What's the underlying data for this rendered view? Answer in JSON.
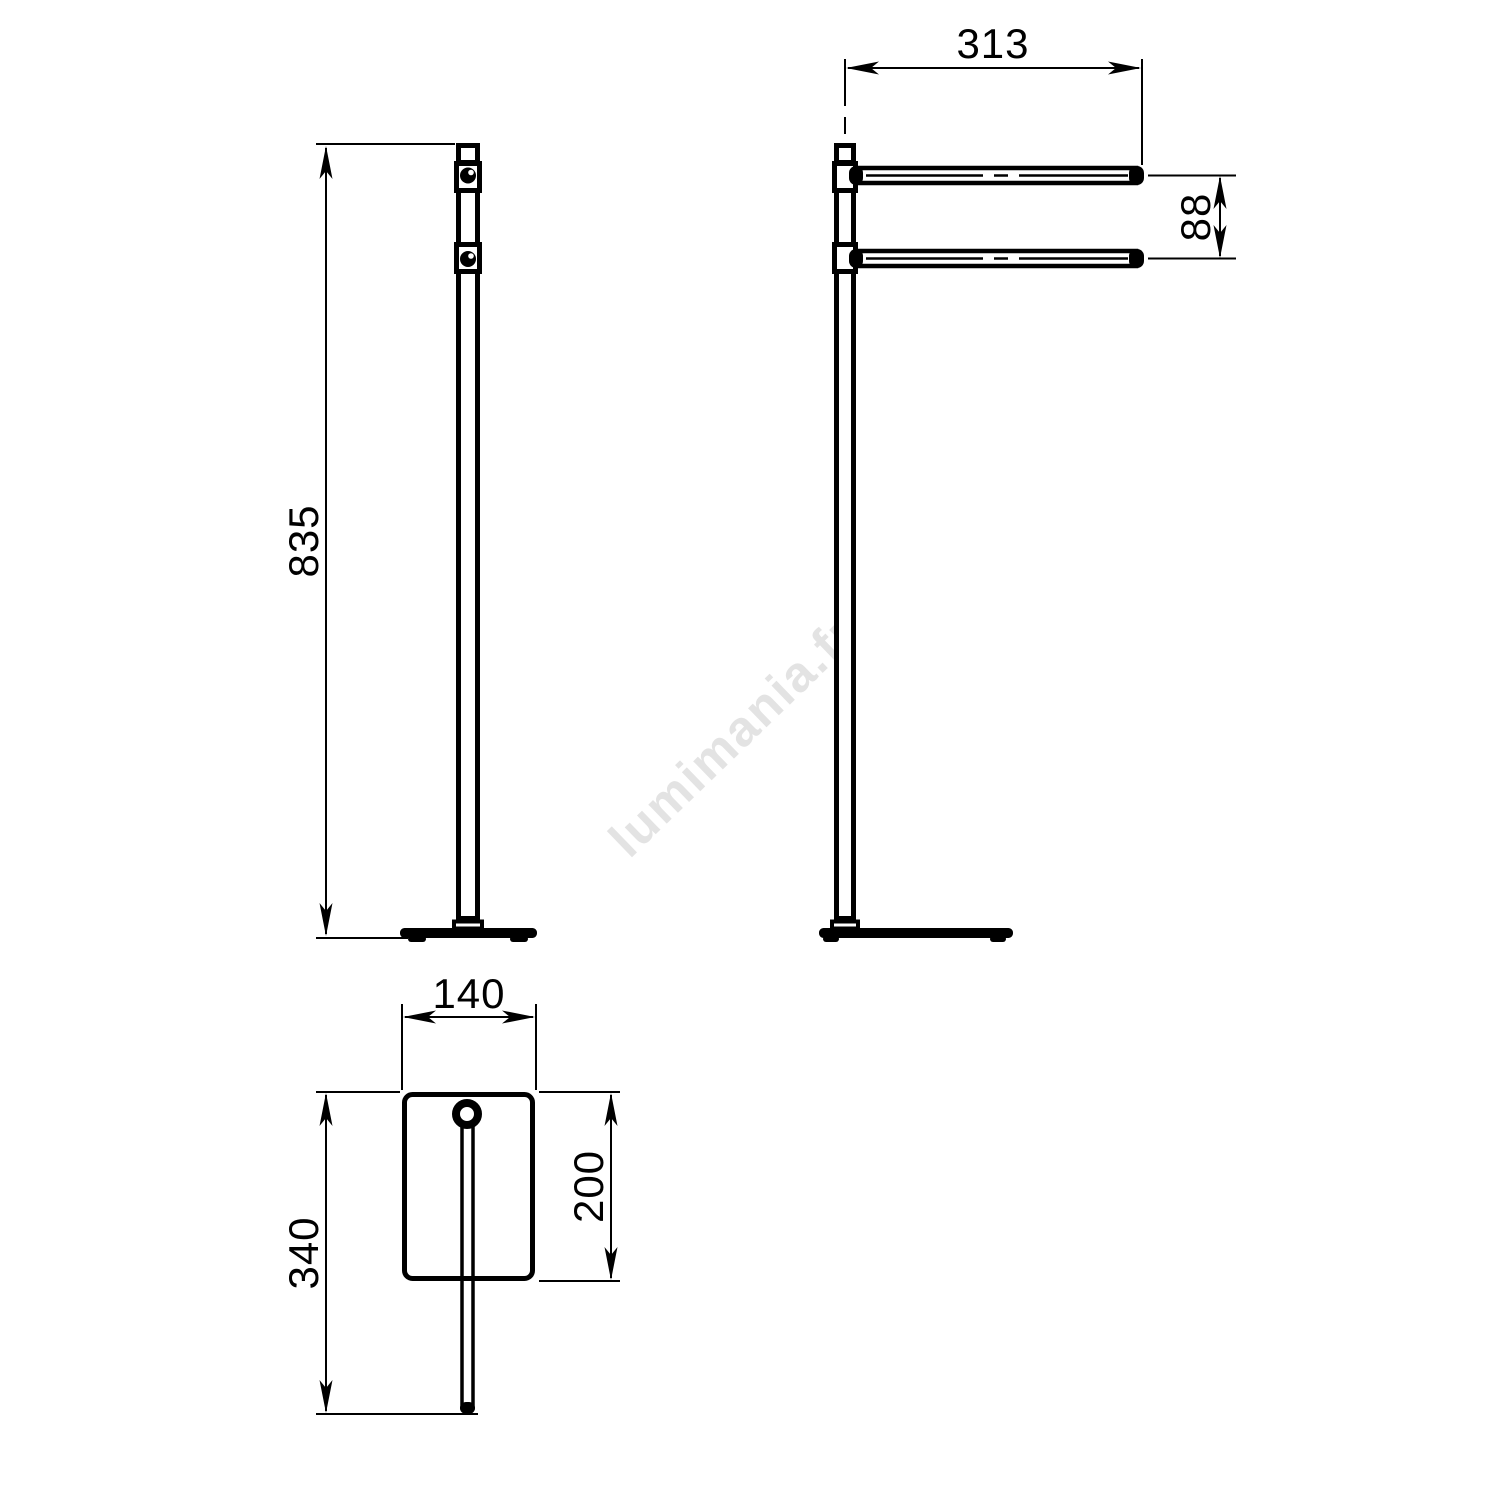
{
  "watermark": {
    "text": "lumimania.fr"
  },
  "dimensions": {
    "height": "835",
    "bar_length": "313",
    "bar_spacing": "88",
    "base_width": "140",
    "base_depth": "200",
    "overall_depth": "340"
  },
  "colors": {
    "line": "#000000",
    "watermark": "#e3e3e3",
    "background": "#ffffff"
  }
}
